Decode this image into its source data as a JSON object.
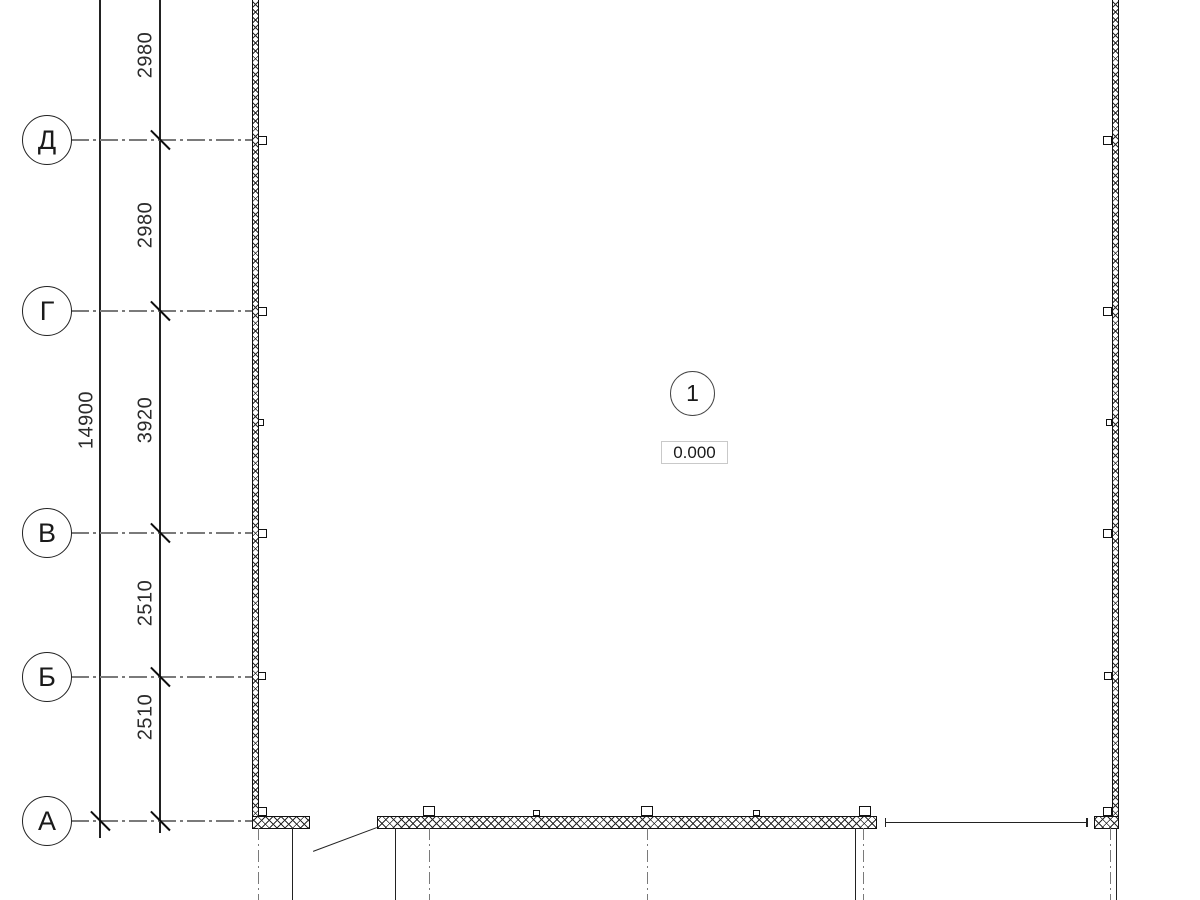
{
  "drawing": {
    "grid_axes": {
      "rows": [
        {
          "label": "Д"
        },
        {
          "label": "Г"
        },
        {
          "label": "В"
        },
        {
          "label": "Б"
        },
        {
          "label": "А"
        }
      ]
    },
    "dimensions": {
      "segments": [
        {
          "value": "2980"
        },
        {
          "value": "2980"
        },
        {
          "value": "3920"
        },
        {
          "value": "2510"
        },
        {
          "value": "2510"
        }
      ],
      "overall": "14900"
    },
    "room": {
      "number": "1",
      "elevation": "0.000"
    },
    "colors": {
      "line": "#1a1a1a",
      "axis_line": "#7a7a7a",
      "elevation_box_border": "#c9c9c9",
      "background": "#ffffff"
    }
  }
}
